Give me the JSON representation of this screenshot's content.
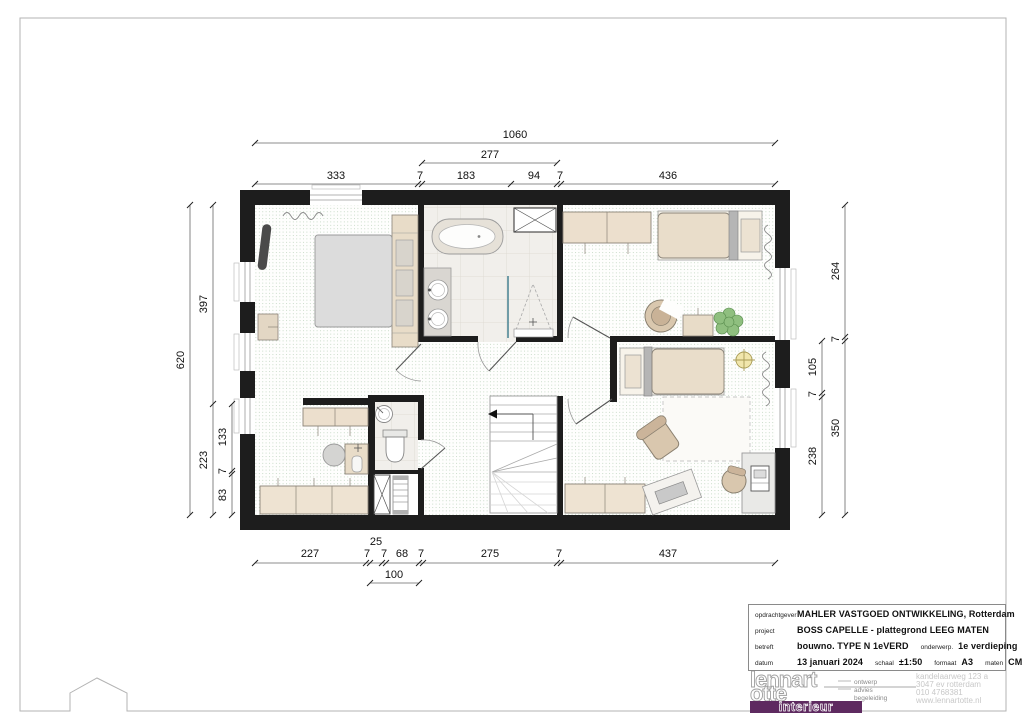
{
  "sheet": {
    "drawing_type": "floor-plan"
  },
  "dims": {
    "top_overall": "1060",
    "top_sub": "277",
    "top_row": [
      "333",
      "7",
      "183",
      "94",
      "7",
      "436"
    ],
    "bottom_row": [
      "227",
      "7",
      "7",
      "68",
      "7",
      "275",
      "7",
      "437"
    ],
    "bottom_above": "25",
    "bottom_sub": "100",
    "left_overall": "620",
    "left_mid": [
      "397",
      "223"
    ],
    "left_inner": [
      "133",
      "7",
      "83"
    ],
    "right_inner": [
      "105",
      "7",
      "238"
    ],
    "right_outer": [
      "264",
      "7",
      "350"
    ]
  },
  "title_block": {
    "row1_label": "opdrachtgever",
    "row1_value": "MAHLER VASTGOED ONTWIKKELING, Rotterdam",
    "row2_label": "project",
    "row2_value": "BOSS CAPELLE - plattegrond LEEG MATEN",
    "row3_label": "betreft",
    "row3_value": "bouwno. TYPE N  1eVERD",
    "row3_label2": "onderwerp.",
    "row3_value2": "1e verdieping",
    "row4_label": "datum",
    "row4_value": "13 januari 2024",
    "row4_label2": "schaal",
    "row4_value2": "±1:50",
    "row4_label3": "formaat",
    "row4_value3": "A3",
    "row4_label4": "maten",
    "row4_value4": "CM"
  },
  "logo": {
    "name_line1": "lennart",
    "name_line2": "otte",
    "band": "interieur",
    "services": [
      "ontwerp",
      "advies",
      "begeleiding"
    ],
    "address_lines": [
      "kandelaarweg 123 a",
      "3047 ev rotterdam",
      "010 4768381",
      "www.lennartotte.nl"
    ]
  },
  "colors": {
    "wall": "#1d1d1d",
    "brand_purple": "#5e2a60",
    "carpet_dot": "#a3c2a3",
    "furniture_beige": "#e9ddca",
    "glass_teal": "#4f8696",
    "light_yellow": "#f1e6ac",
    "plant_green": "#8fbf7f"
  }
}
